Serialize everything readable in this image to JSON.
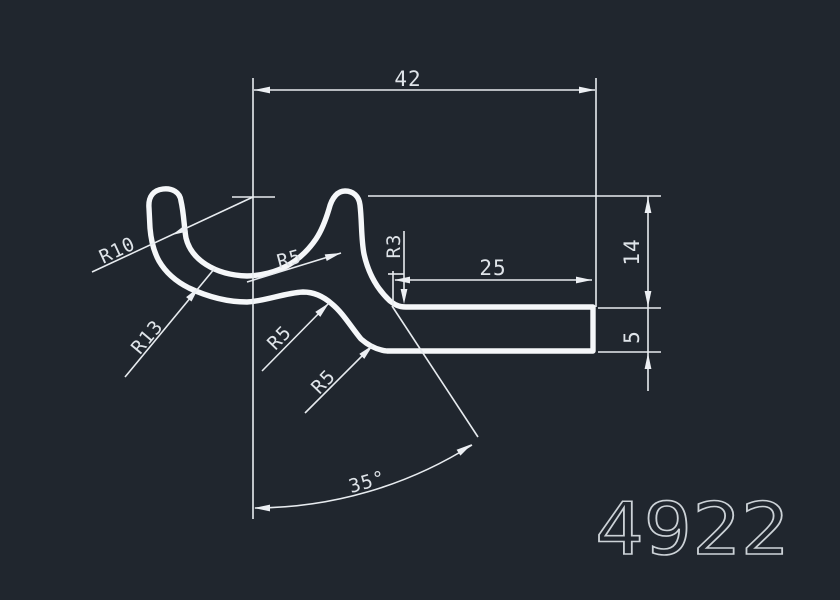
{
  "drawing": {
    "part_number": "4922"
  },
  "dims": {
    "top_width": "42",
    "bar_length": "25",
    "right_height": "14",
    "bar_thickness": "5",
    "angle": "35°"
  },
  "radii": {
    "upper_left": "R10",
    "lower_left": "R13",
    "mid": "R5",
    "s_upper": "R5",
    "s_lower": "R5",
    "fillet": "R3"
  },
  "colors": {
    "background": "#20262e",
    "line": "#e7ebef",
    "profile": "#f5f7f9",
    "text": "#dfe4e9",
    "part_number": "#ccd2d7"
  }
}
